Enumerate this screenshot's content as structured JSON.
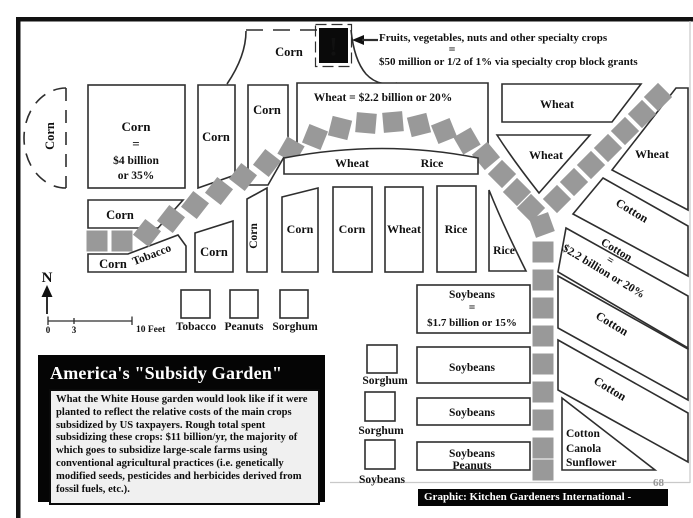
{
  "title_box": {
    "title": "America's \"Subsidy Garden\"",
    "body": "What the White House garden would look like if it were planted to reflect the relative costs of the main crops subsidized by US taxpayers. Rough total spent subsidizing these crops: $11 billion/yr, the majority of which goes to subsidize large-scale farms using conventional agricultural practices (i.e. genetically modified seeds, pesticides and herbicides derived from fossil fuels, etc.)."
  },
  "annotation": {
    "line1": "Fruits, vegetables, nuts and other specialty crops",
    "equals": "=",
    "line2": "$50 million or 1/2 of 1% via specialty crop block grants",
    "icon_glyph": "!"
  },
  "compass": {
    "north": "N"
  },
  "scale": {
    "zero": "0",
    "three": "3",
    "ten": "10 Feet"
  },
  "legend": {
    "items": [
      {
        "label": "Tobacco"
      },
      {
        "label": "Peanuts"
      },
      {
        "label": "Sorghum"
      }
    ]
  },
  "beds": {
    "corn_arc": "Corn",
    "corn_main": {
      "l1": "Corn",
      "l2": "=",
      "l3": "$4 billion",
      "l4": "or 35%"
    },
    "corn_tall": "Corn",
    "corn_pentagon": "Corn",
    "corn_plaza": "Corn",
    "wheat_main": "Wheat = $2.2 billion or 20%",
    "wheat_strip": {
      "wheat": "Wheat",
      "rice": "Rice"
    },
    "wheat_top_right": "Wheat",
    "wheat_triangle_mid": "Wheat",
    "wheat_triangle_right": "Wheat",
    "corn_left_row": "Corn",
    "corn_tobacco": {
      "corn": "Corn",
      "tobacco": "Tobacco"
    },
    "corn_small": "Corn",
    "corn_vertical": "Corn",
    "row_corn1": "Corn",
    "row_corn2": "Corn",
    "row_wheat": "Wheat",
    "row_rice": "Rice",
    "rice_curve": "Rice",
    "soybeans_main": {
      "l1": "Soybeans",
      "l2": "=",
      "l3": "$1.7 billion or 15%"
    },
    "soybeans_2": "Soybeans",
    "soybeans_3": "Soybeans",
    "soybeans_peanuts": {
      "l1": "Soybeans",
      "l2": "Peanuts"
    },
    "sorghum_sq1": "Sorghum",
    "sorghum_sq2": "Sorghum",
    "soybeans_sq": "Soybeans",
    "cotton_1": "Cotton",
    "cotton_2": {
      "l1": "Cotton",
      "l2": "=",
      "l3": "$2.2 billion or 20%"
    },
    "cotton_3": "Cotton",
    "cotton_4": "Cotton",
    "cotton_canola": {
      "l1": "Cotton",
      "l2": "Canola",
      "l3": "Sunflower"
    }
  },
  "credit": {
    "text": "Graphic: Kitchen Gardeners International - KGI.org",
    "page_number": "68"
  },
  "colors": {
    "path_squares": "#999999",
    "bed_outline": "#2e2e2e",
    "frame_black": "#111111",
    "title_bg": "#000000",
    "title_fg": "#ffffff",
    "credit_bg": "#000000",
    "credit_fg": "#ffffff",
    "background": "#ffffff"
  }
}
